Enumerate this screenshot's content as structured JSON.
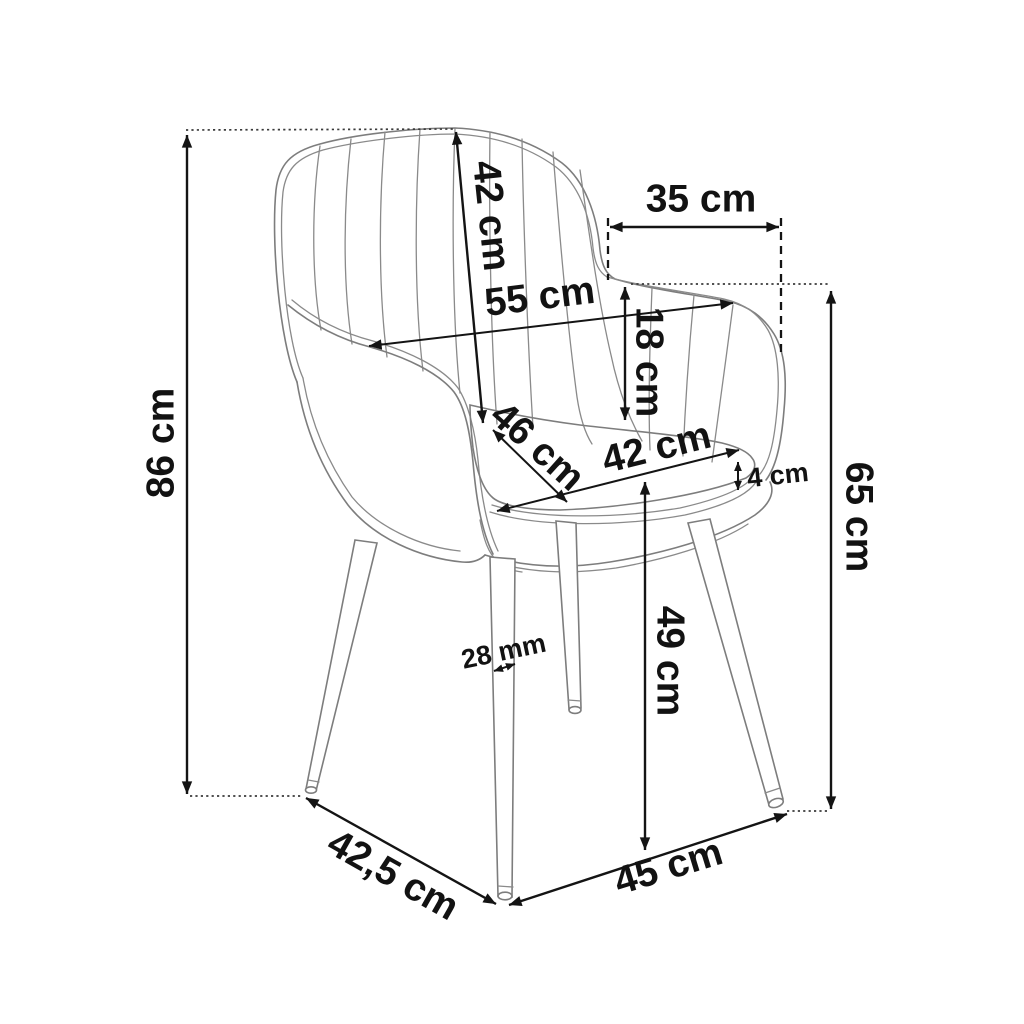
{
  "figure": {
    "kind": "furniture dimension diagram",
    "subject": "upholstered armchair with vertically pleated backrest, curled armrests and four tapered legs",
    "background_color": "#ffffff",
    "line_color": "#141414",
    "drawing_color": "#7d7d7d"
  },
  "dimensions": {
    "overall_height": {
      "label": "86 cm",
      "value": 86,
      "unit": "cm",
      "measures": "total chair height, floor to top of backrest"
    },
    "backrest_height": {
      "label": "42 cm",
      "value": 42,
      "unit": "cm",
      "measures": "backrest height along the back"
    },
    "backrest_width": {
      "label": "55 cm",
      "value": 55,
      "unit": "cm",
      "measures": "overall width across backrest between armrests"
    },
    "armrest_top_width": {
      "label": "35 cm",
      "value": 35,
      "unit": "cm",
      "measures": "width across the top opening between armrests"
    },
    "armrest_to_seat": {
      "label": "18 cm",
      "value": 18,
      "unit": "cm",
      "measures": "height from seat surface to armrest top"
    },
    "armrest_height": {
      "label": "65 cm",
      "value": 65,
      "unit": "cm",
      "measures": "floor to armrest top"
    },
    "seat_depth": {
      "label": "46 cm",
      "value": 46,
      "unit": "cm",
      "measures": "seat depth"
    },
    "seat_width": {
      "label": "42 cm",
      "value": 42,
      "unit": "cm",
      "measures": "seat cushion width"
    },
    "cushion_thickness": {
      "label": "4 cm",
      "value": 4,
      "unit": "cm",
      "measures": "seat cushion thickness"
    },
    "seat_height": {
      "label": "49 cm",
      "value": 49,
      "unit": "cm",
      "measures": "floor to seat surface"
    },
    "leg_diameter": {
      "label": "28 mm",
      "value": 28,
      "unit": "mm",
      "measures": "leg tube diameter"
    },
    "base_depth": {
      "label": "42,5 cm",
      "value": 42.5,
      "unit": "cm",
      "measures": "footprint depth, back leg to front leg"
    },
    "base_width": {
      "label": "45 cm",
      "value": 45,
      "unit": "cm",
      "measures": "footprint width between front legs"
    }
  }
}
